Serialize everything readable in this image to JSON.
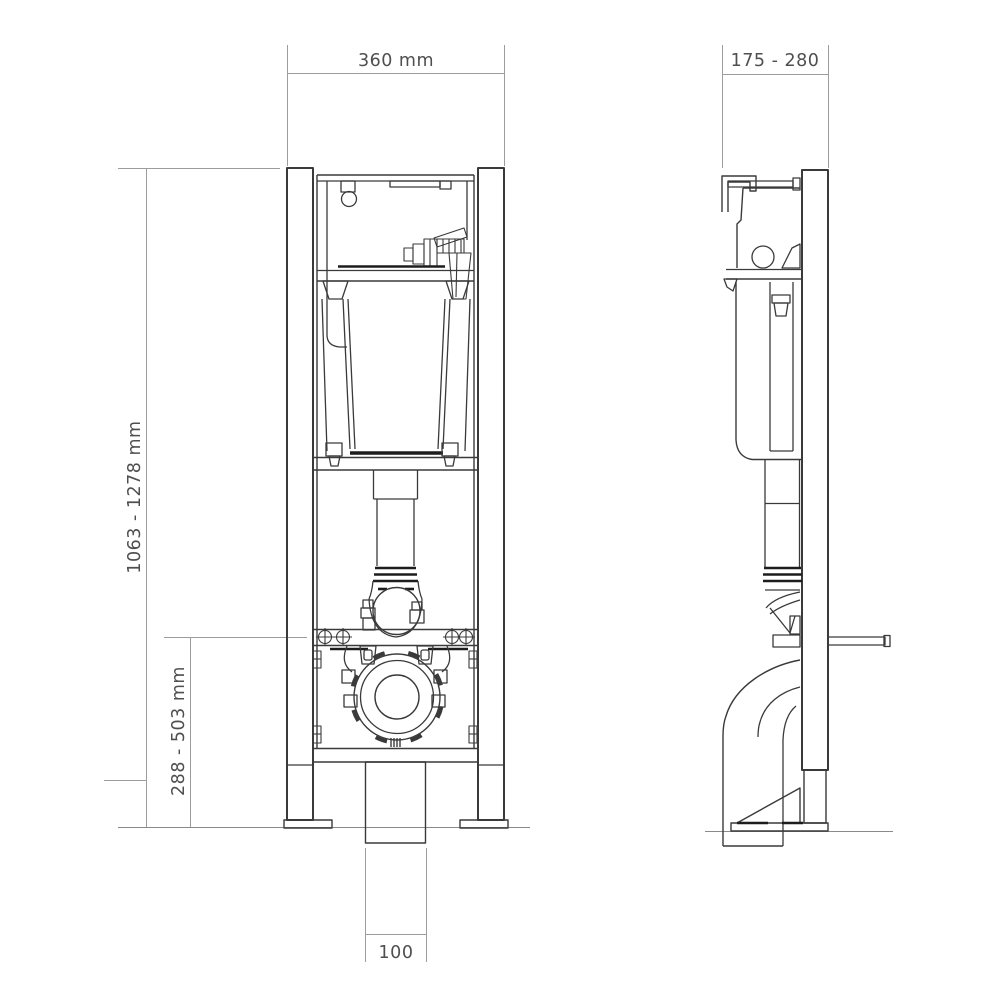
{
  "drawing": {
    "dimensions": {
      "frame_width": "360 mm",
      "frame_depth": "175 - 280",
      "frame_height": "1063 - 1278 mm",
      "outlet_height": "288 - 503 mm",
      "outlet_offset": "100"
    },
    "colors": {
      "line": "#3a3a3a",
      "dark_line": "#1d1d1d",
      "dimension_line": "#9c9c9c",
      "ground_line": "#8a8a8a",
      "label_text": "#4f4f4f",
      "background": "#ffffff"
    }
  }
}
